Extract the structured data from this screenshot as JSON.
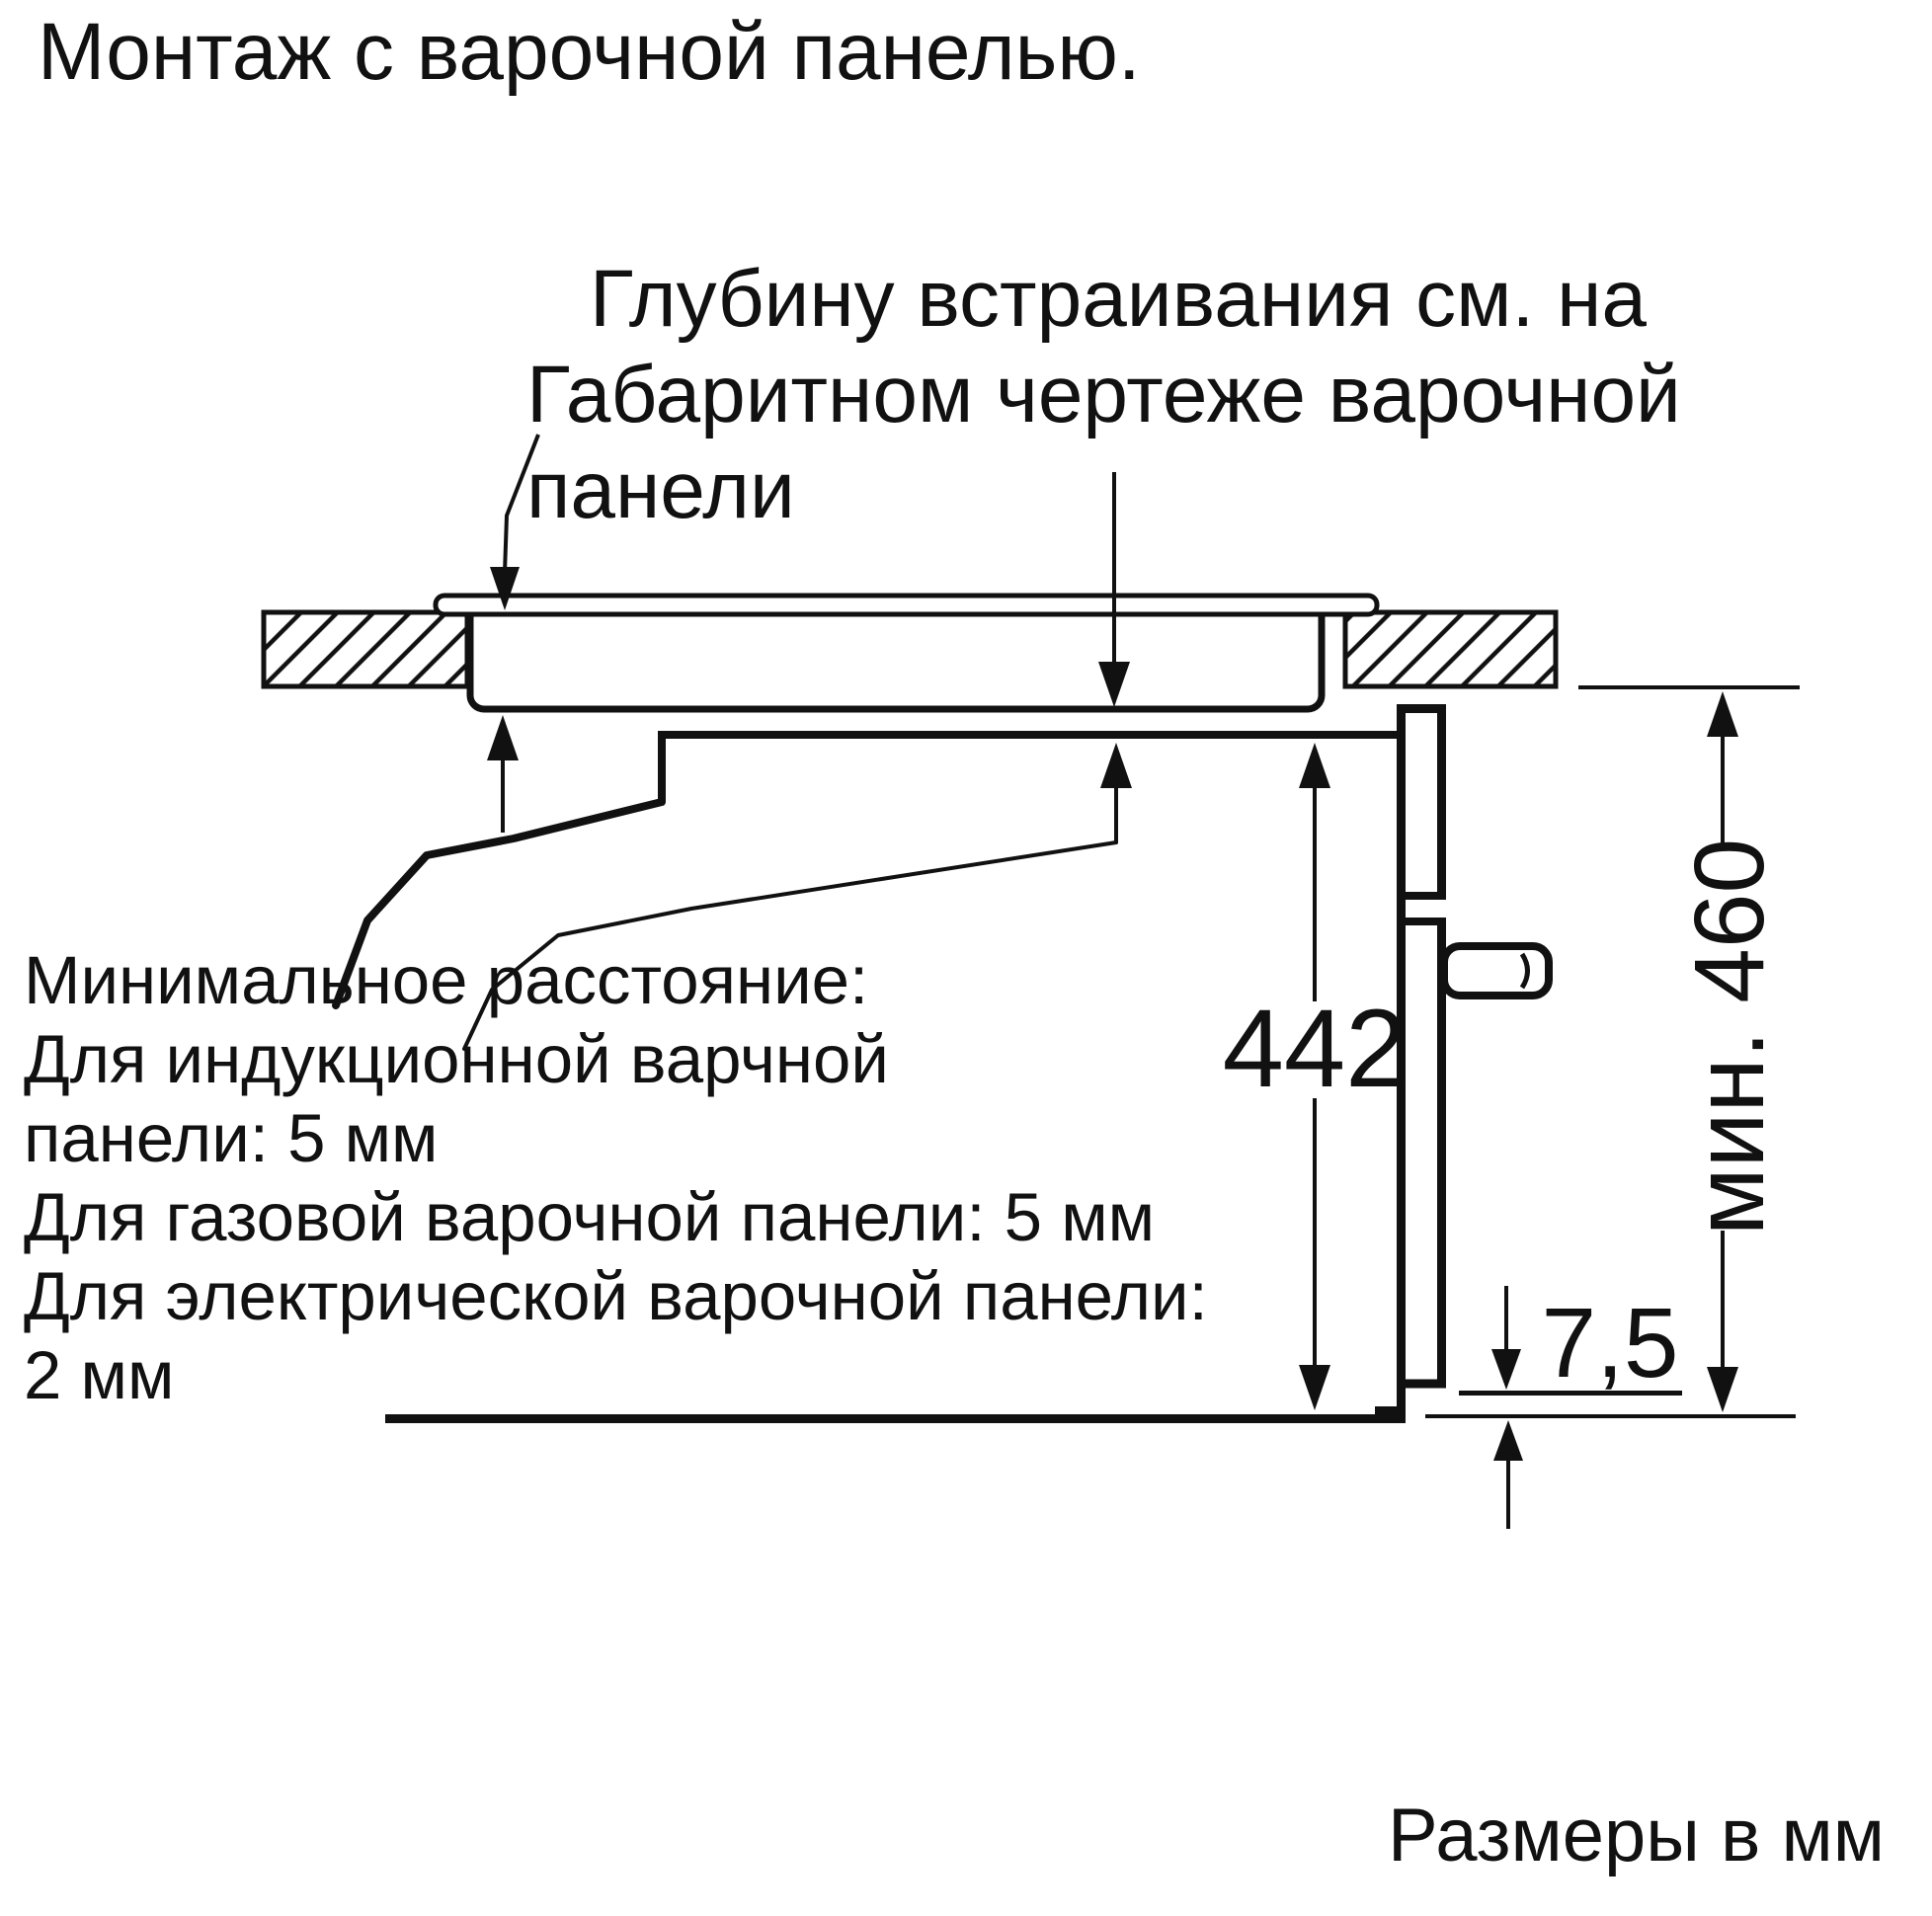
{
  "title": {
    "text": "Монтаж с варочной панелью."
  },
  "callout": {
    "line1": "Глубину встраивания см. на",
    "line2": "Габаритном чертеже варочной",
    "line3": "панели"
  },
  "notes": {
    "line1": "Минимальное расстояние:",
    "line2": "Для индукционной варчной",
    "line3": "панели: 5 мм",
    "line4": "Для газовой варочной панели: 5 мм",
    "line5": "Для электрической варочной панели:",
    "line6": "2 мм"
  },
  "dimensions": {
    "oven_height": "442",
    "min_niche_height": "мин. 460",
    "door_bottom_gap": "7,5"
  },
  "footer": {
    "text": "Размеры в мм"
  },
  "colors": {
    "ink": "#111111",
    "background": "#ffffff"
  }
}
